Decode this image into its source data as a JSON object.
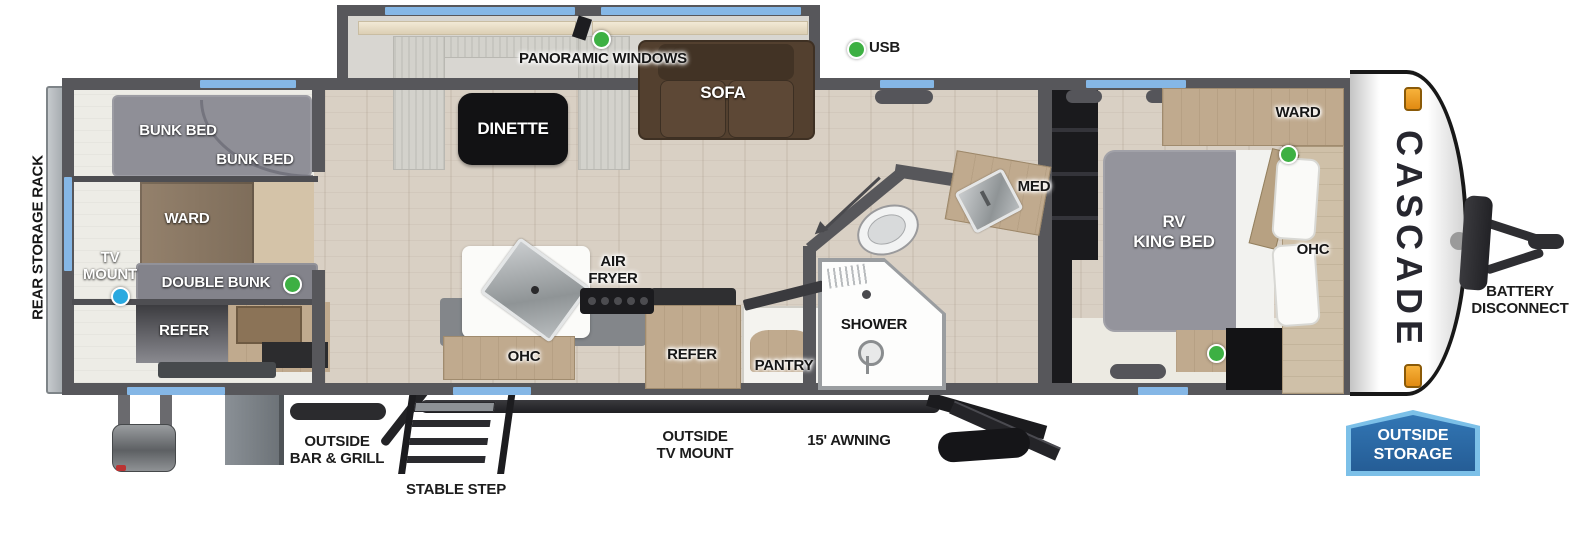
{
  "diagram_type": "rv-travel-trailer-floorplan",
  "brand": {
    "logo_text": "CASCADE"
  },
  "colors": {
    "wall": "#57575b",
    "window_blue": "#85b7e6",
    "marker_green": "#3db043",
    "marker_blue": "#2aa9e0",
    "floor_wood": "#d9d0c4",
    "cabinet_wood": "#c0aa8e",
    "sofa_brown": "#53402f",
    "bed_gray": "#94949c",
    "badge_fill_blue": "#2e6fae",
    "badge_border_blue": "#7cc0e8",
    "marker_light_orange": "#f0a02a"
  },
  "areas": {
    "rear_exterior": {
      "rack_label": "REAR STORAGE RACK"
    },
    "bunk_room": {
      "bunk_bed_upper": "BUNK BED",
      "bunk_bed_lower": "BUNK BED",
      "ward": "WARD",
      "tv_mount_line1": "TV",
      "tv_mount_line2": "MOUNT",
      "double_bunk": "DOUBLE BUNK",
      "refer": "REFER"
    },
    "slide_out": {
      "panoramic_windows": "PANORAMIC WINDOWS",
      "dinette": "DINETTE",
      "sofa": "SOFA"
    },
    "living": {
      "usb": "USB"
    },
    "kitchen": {
      "air_fryer_line1": "AIR",
      "air_fryer_line2": "FRYER",
      "ohc": "OHC",
      "refer": "REFER",
      "pantry": "PANTRY"
    },
    "bathroom": {
      "shower": "SHOWER",
      "med": "MED"
    },
    "bedroom": {
      "bed_line1": "RV",
      "bed_line2": "KING BED",
      "ward": "WARD",
      "ohc": "OHC"
    },
    "front_exterior": {
      "battery_line1": "BATTERY",
      "battery_line2": "DISCONNECT"
    },
    "bottom_exterior": {
      "bar_grill_line1": "OUTSIDE",
      "bar_grill_line2": "BAR & GRILL",
      "stable_step": "STABLE STEP",
      "tv_mount_line1": "OUTSIDE",
      "tv_mount_line2": "TV MOUNT",
      "awning": "15' AWNING",
      "storage_line1": "OUTSIDE",
      "storage_line2": "STORAGE"
    }
  }
}
